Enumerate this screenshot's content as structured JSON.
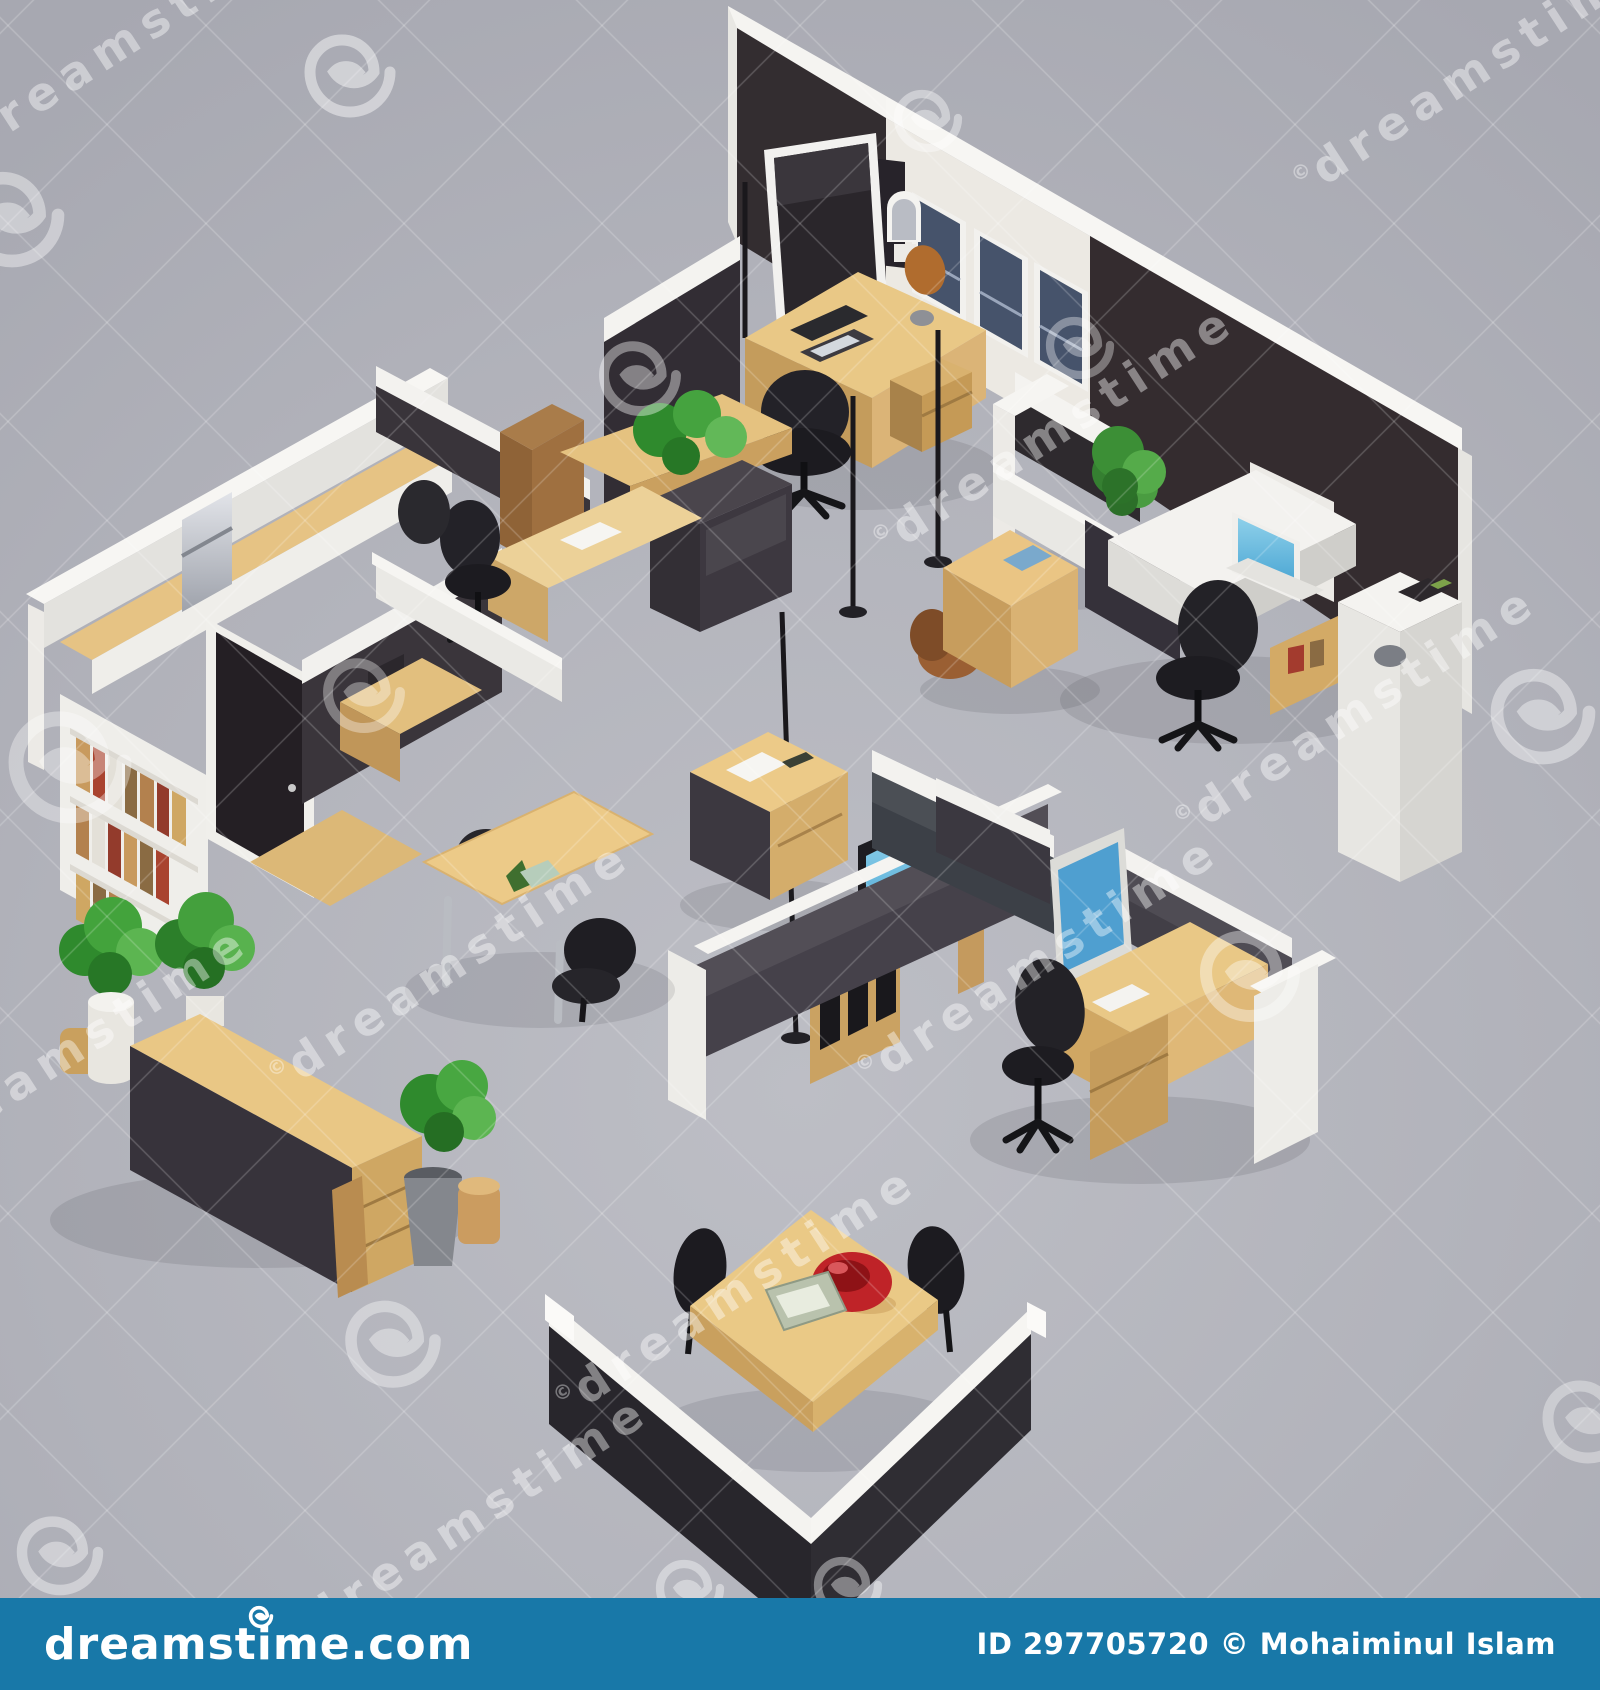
{
  "image": {
    "description": "Isometric 3D render of an office floor plan with cubicles, desks, chairs, plants and partition walls (stock photo preview)"
  },
  "watermark": {
    "text": "dreamstime",
    "copyright_symbol": "©",
    "text_color": "rgba(255,255,255,0.42)",
    "grid_line_color": "rgba(255,255,255,0.17)"
  },
  "footer": {
    "bar_color": "#1878a8",
    "logo_text": "dreamstime.com",
    "credit_text": "ID 297705720 © Mohaiminul Islam",
    "text_color": "#ffffff"
  },
  "palette": {
    "background_gray": "#b0b1b9",
    "wall_dark": "#352d31",
    "wall_white": "#f2f1ee",
    "window_navy": "#46536b",
    "wood_light": "#e9c886",
    "wood_mid": "#c9a05f",
    "partition_dark": "#423f47",
    "chair_black": "#1f1e23",
    "screen_blue": "#58aeda",
    "plant_green": "#3f9b38",
    "bowl_red": "#bf2328"
  }
}
